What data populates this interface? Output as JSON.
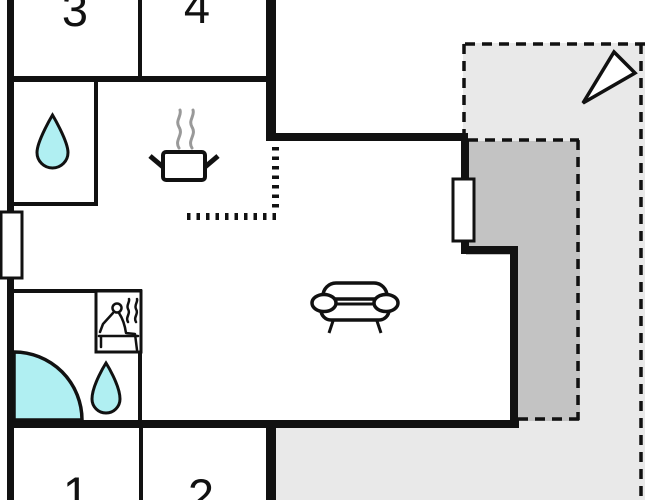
{
  "plan": {
    "title": "holiday-home-floor-plan",
    "rooms": [
      {
        "label": "3"
      },
      {
        "label": "4"
      },
      {
        "label": "1"
      },
      {
        "label": "2"
      }
    ],
    "areas": {
      "terrace_outer": "open terrace (light gray, dashed outline)",
      "terrace_covered": "covered terrace (dark gray, dashed outline)"
    },
    "icons": {
      "toilet": "water-drop-icon",
      "bathroom": "water-drop-icon",
      "kitchen": "cooking-pot-steam-icon",
      "sauna": "sauna-person-icon",
      "corner_bath": "corner-bathtub-icon",
      "living": "sofa-icon",
      "compass": "north-arrow-icon"
    },
    "colors": {
      "wall": "#111111",
      "water": "#b0eff2",
      "terrace_light": "#e9e9e9",
      "terrace_dark": "#c3c3c3",
      "steam": "#999999",
      "background": "#ffffff"
    }
  }
}
